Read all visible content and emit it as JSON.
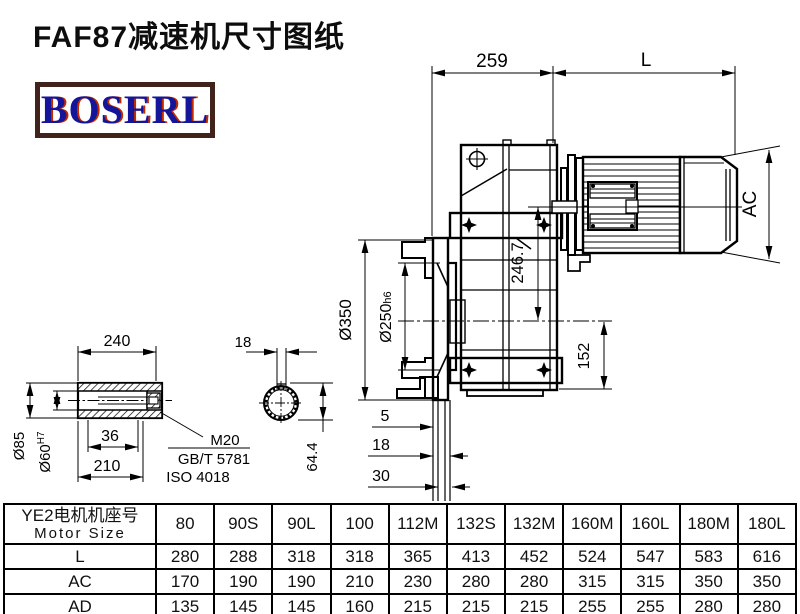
{
  "title": "FAF87减速机尺寸图纸",
  "logo": "BOSERL",
  "drawing": {
    "dim_259": "259",
    "dim_L": "L",
    "dim_AC": "AC",
    "dim_246": "246.7",
    "dim_350": "Ø350",
    "dim_250": "Ø250",
    "dim_250_tol": "h6",
    "dim_152": "152",
    "dim_5": "5",
    "dim_18": "18",
    "dim_30": "30",
    "shaft_240": "240",
    "shaft_85": "Ø85",
    "shaft_60": "Ø60",
    "shaft_60_tol": "H7",
    "shaft_36": "36",
    "shaft_210": "210",
    "thread": "M20",
    "std_gb": "GB/T 5781",
    "std_iso": "ISO 4018",
    "key_18": "18",
    "key_644": "64.4"
  },
  "table": {
    "header_cn": "YE2电机机座号",
    "header_en": "Motor Size",
    "columns": [
      "80",
      "90S",
      "90L",
      "100",
      "112M",
      "132S",
      "132M",
      "160M",
      "160L",
      "180M",
      "180L"
    ],
    "rows": [
      {
        "label": "L",
        "values": [
          "280",
          "288",
          "318",
          "318",
          "365",
          "413",
          "452",
          "524",
          "547",
          "583",
          "616"
        ]
      },
      {
        "label": "AC",
        "values": [
          "170",
          "190",
          "190",
          "210",
          "230",
          "280",
          "280",
          "315",
          "315",
          "350",
          "350"
        ]
      },
      {
        "label": "AD",
        "values": [
          "135",
          "145",
          "145",
          "160",
          "215",
          "215",
          "215",
          "255",
          "255",
          "280",
          "280"
        ]
      }
    ]
  }
}
